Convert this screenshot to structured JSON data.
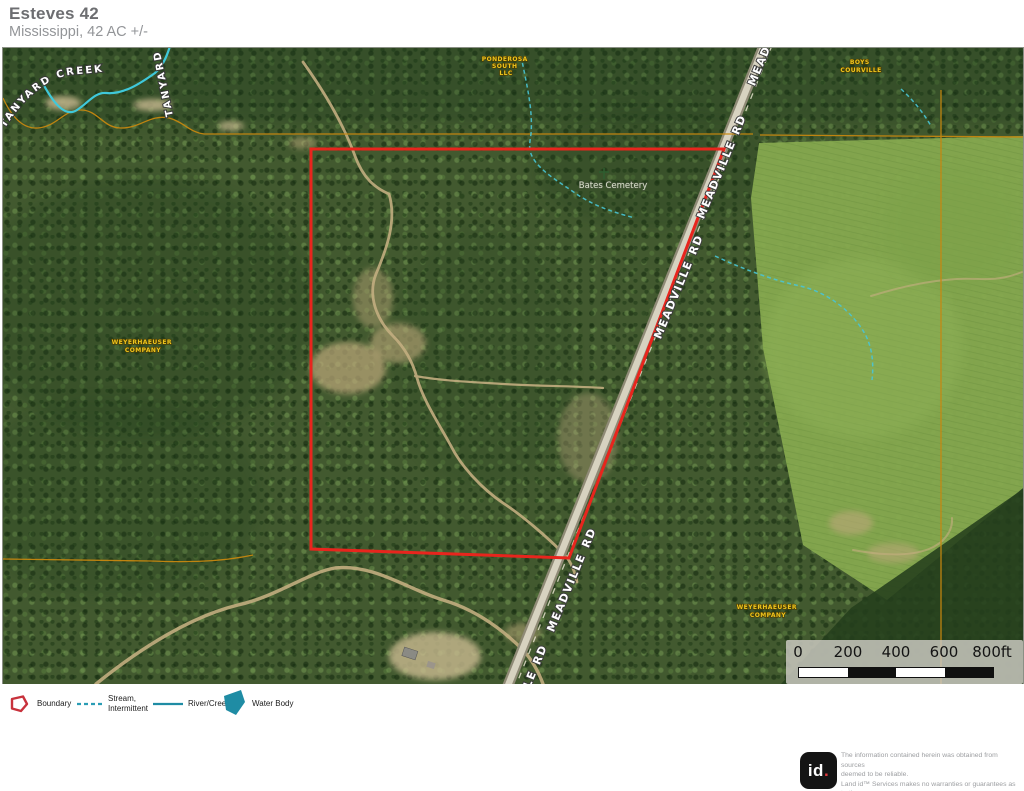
{
  "header": {
    "title": "Esteves 42",
    "subtitle": "Mississippi, 42 AC +/-"
  },
  "map": {
    "road_label": "MEADVILLE RD",
    "creek_label": "TANYARD CREEK",
    "creek_label_vertical": "TANYARD CREEK",
    "cemetery_label": "Bates Cemetery",
    "owners": {
      "ponderosa": {
        "line1": "PONDEROSA",
        "line2": "SOUTH",
        "line3": "LLC"
      },
      "boys": {
        "line1": "BOYS",
        "line2": "COURVILLE"
      },
      "weyerhaeuser_left": {
        "line1": "WEYERHAEUSER",
        "line2": "COMPANY"
      },
      "weyerhaeuser_right": {
        "line1": "WEYERHAEUSER",
        "line2": "COMPANY"
      }
    },
    "scalebar": {
      "ticks": [
        "0",
        "200",
        "400",
        "600",
        "800ft"
      ]
    },
    "colors": {
      "boundary": "#e8251d",
      "parcel_line": "#c7870f",
      "stream": "#49c4d4",
      "water": "#1f8ca4"
    }
  },
  "legend": {
    "items": [
      {
        "label": "Boundary"
      },
      {
        "label": "Stream,\nIntermittent"
      },
      {
        "label": "River/Creek"
      },
      {
        "label": "Water Body"
      }
    ]
  },
  "footer": {
    "logo_text": "id",
    "logo_dot": ".",
    "disclaimer": "The information contained herein was obtained from sources\ndeemed to be reliable.\n Land id™ Services makes no warranties or guarantees as to the\ncompleteness or accuracy thereof."
  }
}
